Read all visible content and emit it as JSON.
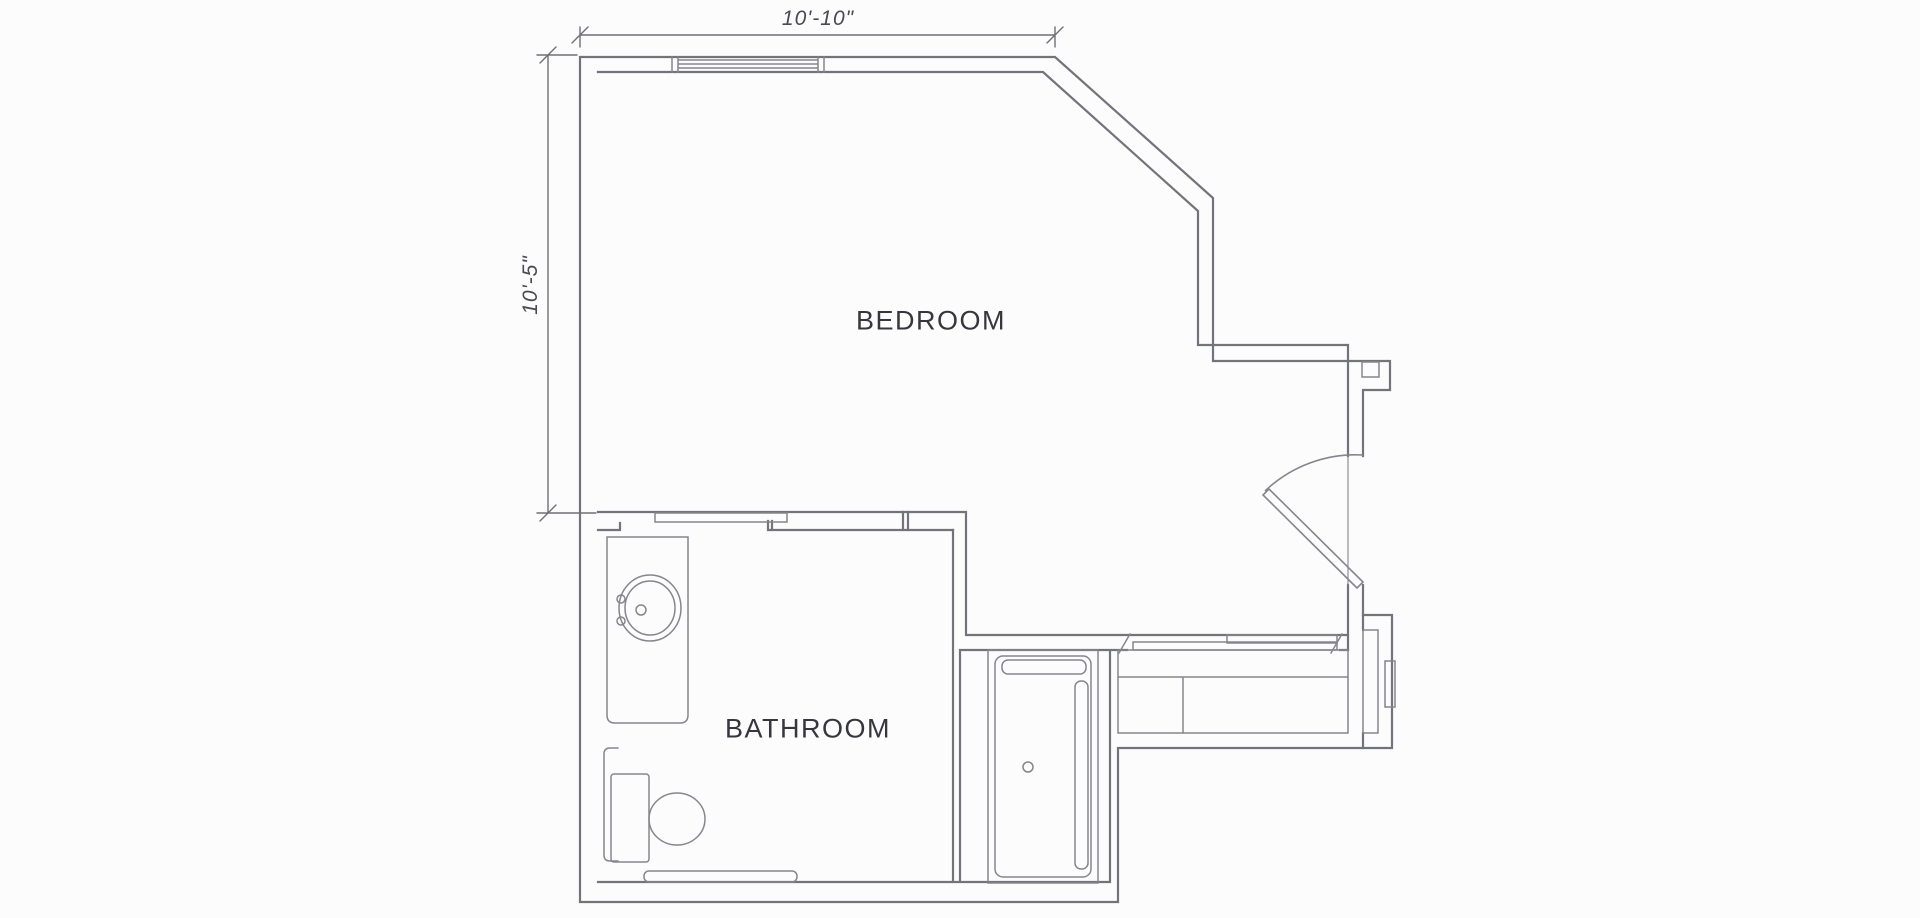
{
  "page": {
    "title": "Bedroom and bathroom floor plan"
  },
  "labels": {
    "bedroom": "BEDROOM",
    "bathroom": "BATHROOM"
  },
  "dimensions": {
    "width_label": "10'-10\"",
    "height_label": "10'-5\""
  },
  "colors": {
    "background": "#fcfcfc",
    "wall_line": "#73737b",
    "fixture_line": "#85858d",
    "dim_line": "#6f6f77",
    "room_text": "#36363c",
    "dim_text": "#4a4a52"
  },
  "fixtures": [
    "entry-door",
    "pocket-door",
    "sliding-closet-doors",
    "vanity-sink",
    "toilet",
    "grab-bar",
    "bath-mat",
    "bathtub-shower",
    "closet-shelves",
    "window",
    "wall-niche"
  ]
}
